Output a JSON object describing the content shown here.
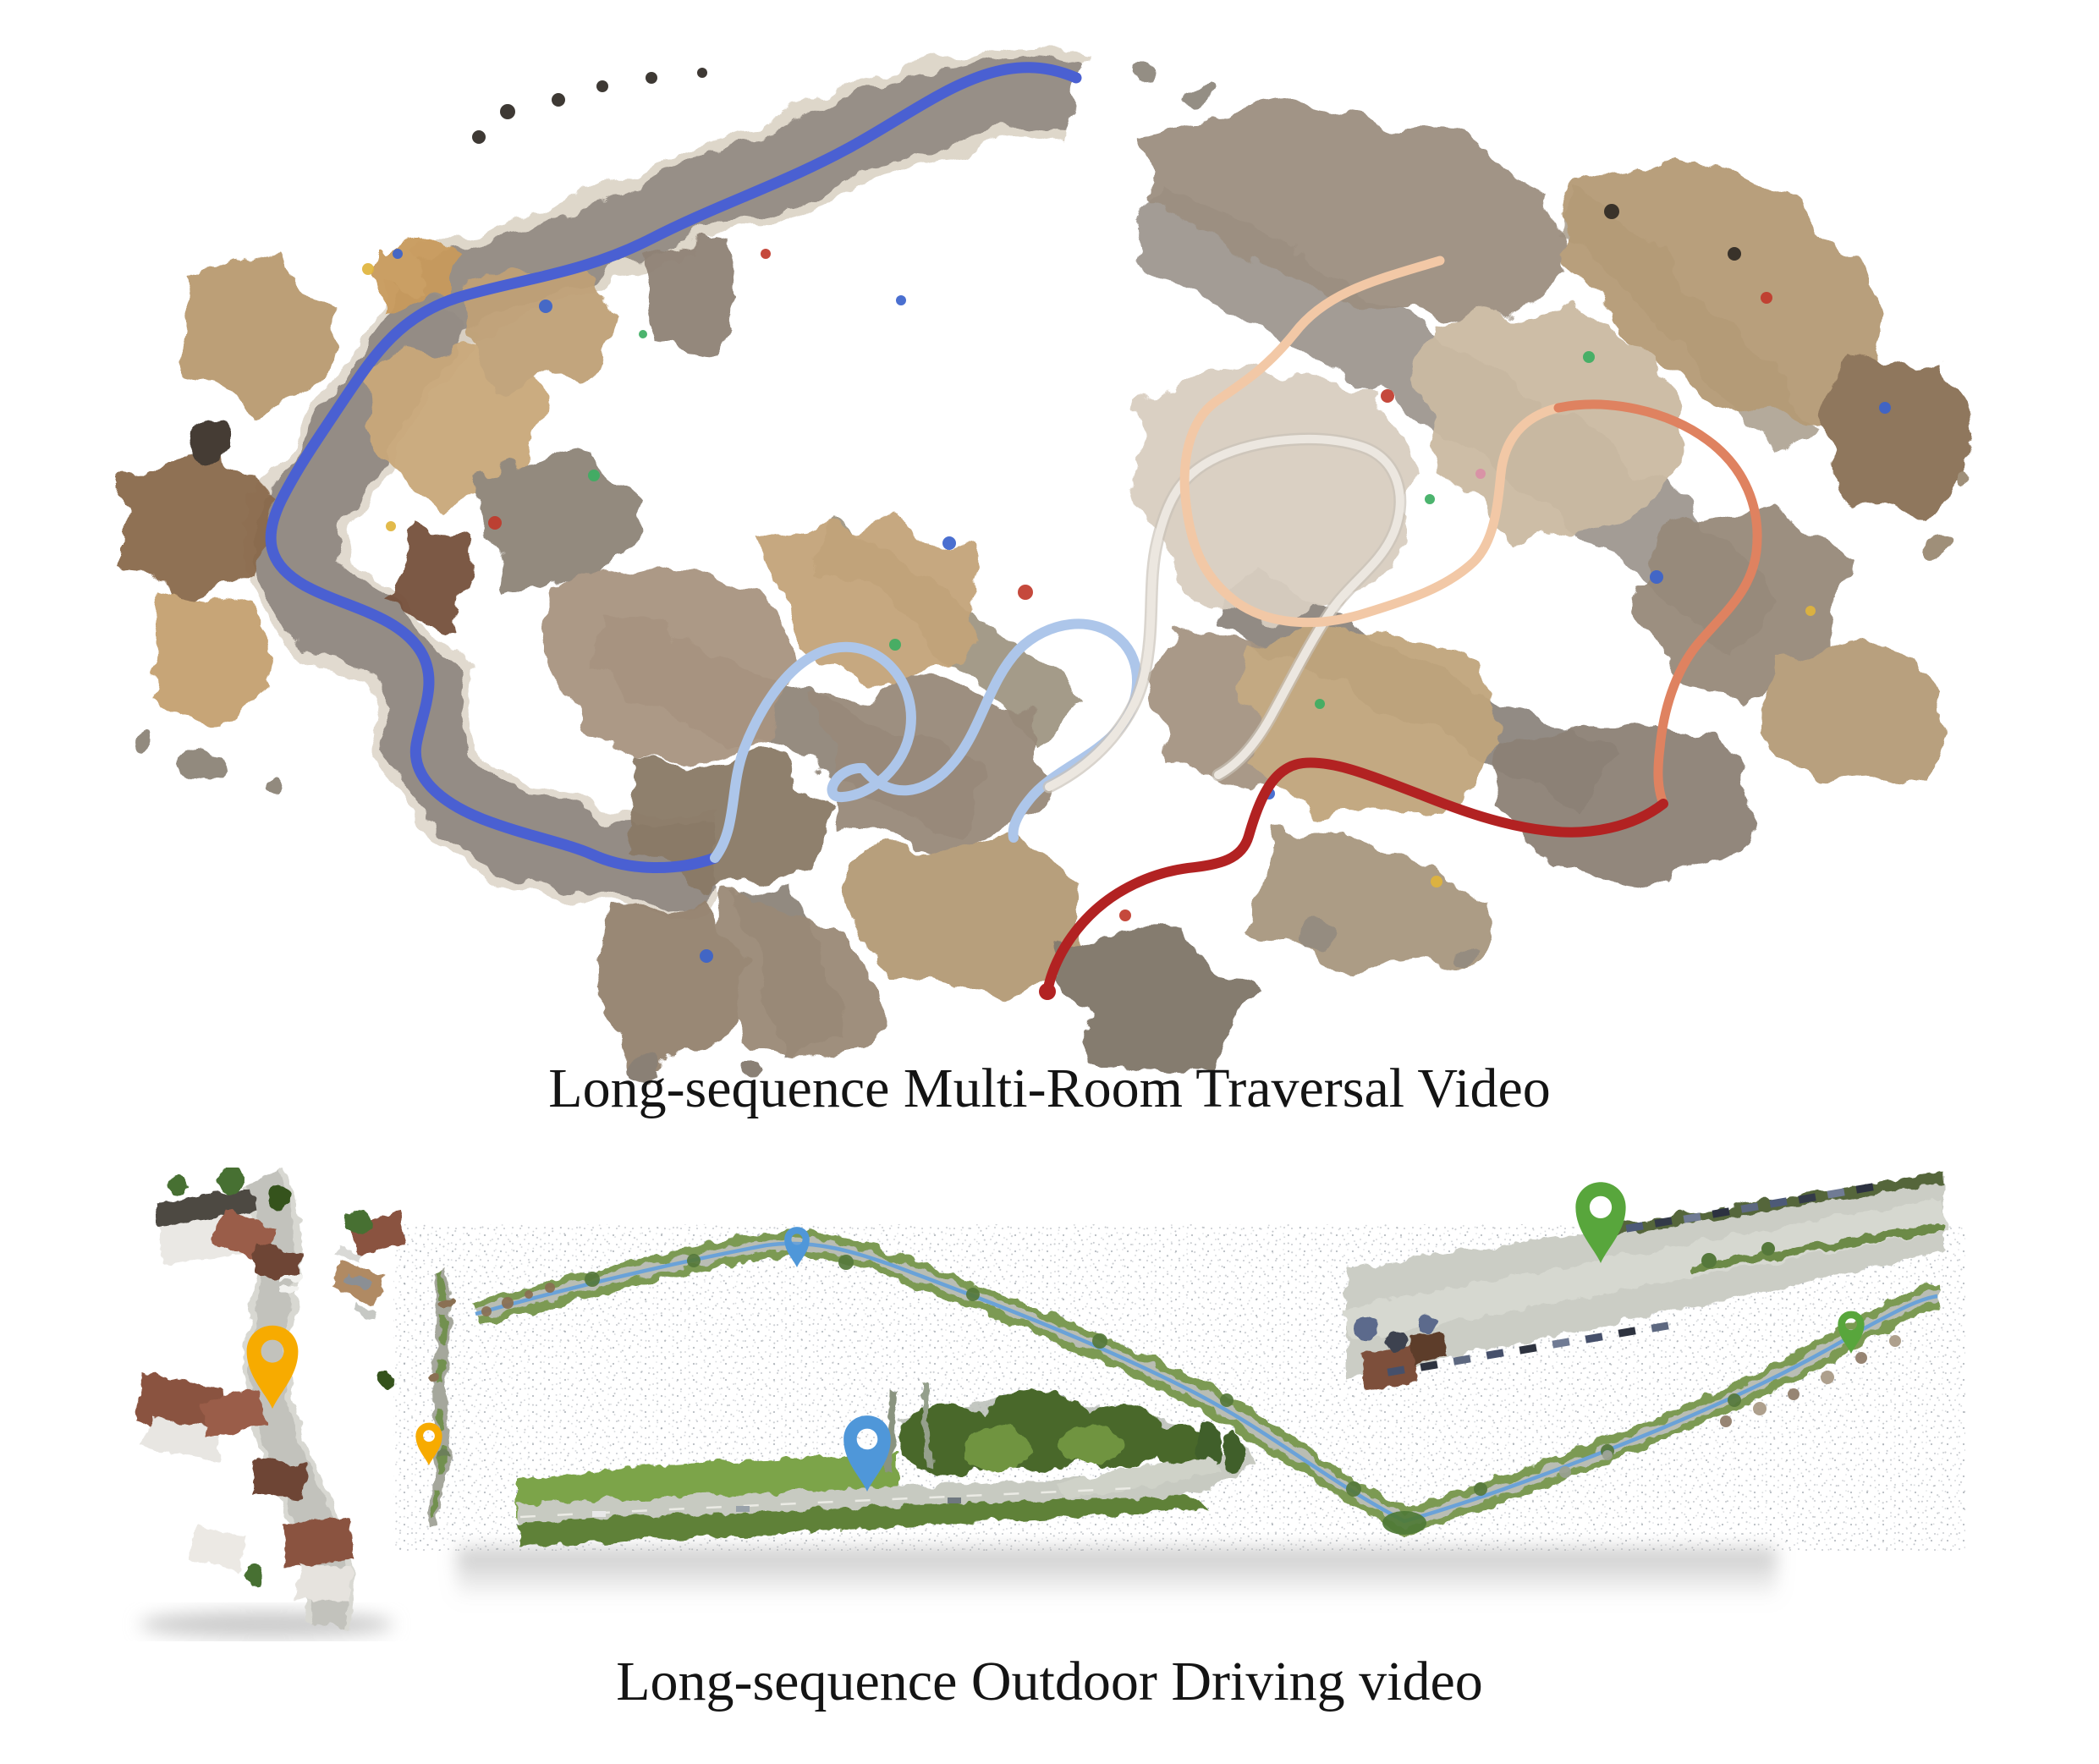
{
  "page": {
    "background": "#ffffff"
  },
  "captions": {
    "top": "Long-sequence Multi-Room Traversal Video",
    "bottom": "Long-sequence Outdoor Driving video"
  },
  "colors": {
    "traj-blue": "#4a60d2",
    "traj-light-blue": "#adc6ea",
    "traj-white": "#ece7e0",
    "traj-peach": "#f2c8a6",
    "traj-salmon": "#df8260",
    "traj-red": "#b22222",
    "pin-yellow": "#f7ab00",
    "pin-blue": "#4f97d9",
    "pin-green": "#58a63c",
    "caption-text": "#141414"
  },
  "icons": {
    "map_pin": "teardrop-location-pin"
  },
  "pins": [
    {
      "id": "pin-yellow-large",
      "color": "pin-yellow",
      "size": "large"
    },
    {
      "id": "pin-yellow-small",
      "color": "pin-yellow",
      "size": "small"
    },
    {
      "id": "pin-blue-small",
      "color": "pin-blue",
      "size": "small"
    },
    {
      "id": "pin-blue-large",
      "color": "pin-blue",
      "size": "large"
    },
    {
      "id": "pin-green-large",
      "color": "pin-green",
      "size": "large"
    },
    {
      "id": "pin-green-small",
      "color": "pin-green",
      "size": "small"
    }
  ],
  "trajectories": [
    {
      "id": "trajectory-blue",
      "color": "traj-blue"
    },
    {
      "id": "trajectory-light-blue",
      "color": "traj-light-blue"
    },
    {
      "id": "trajectory-white",
      "color": "traj-white"
    },
    {
      "id": "trajectory-peach",
      "color": "traj-peach"
    },
    {
      "id": "trajectory-salmon",
      "color": "traj-salmon"
    },
    {
      "id": "trajectory-red",
      "color": "traj-red"
    }
  ]
}
